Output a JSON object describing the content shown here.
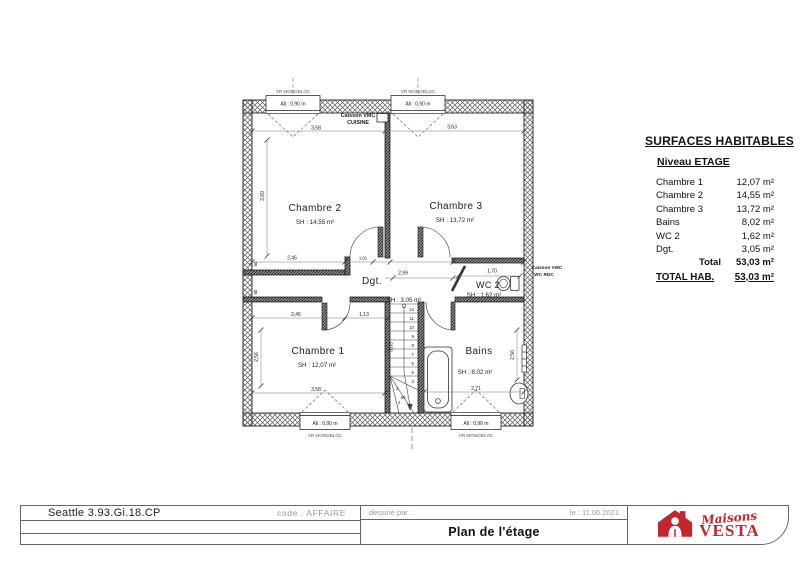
{
  "plan": {
    "rooms": {
      "chambre2": {
        "name": "Chambre 2",
        "area": "SH : 14,55 m²"
      },
      "chambre3": {
        "name": "Chambre 3",
        "area": "SH : 13,72 m²"
      },
      "chambre1": {
        "name": "Chambre 1",
        "area": "SH : 12,07 m²"
      },
      "bains": {
        "name": "Bains",
        "area": "SH : 8,02 m²"
      },
      "wc2": {
        "name": "WC 2",
        "area": "SH : 1,62 m²"
      },
      "dgt": {
        "name": "Dgt.",
        "area": "SH : 3,05 m²"
      }
    },
    "windows": {
      "sill_label": "All : 0,90 m",
      "type_label": "VR MONOBLOC"
    },
    "red_annotations": {
      "vmc_kitchen": {
        "line1": "Caisson VMC",
        "line2": "CUISINE"
      },
      "vmc_wc": {
        "line1": "Caisson VMC",
        "line2": "WC RDC"
      }
    },
    "red_color": "#c1272d",
    "dims": [
      {
        "text": "3,58"
      },
      {
        "text": "3,63"
      },
      {
        "text": "3,60"
      },
      {
        "text": "2,45"
      },
      {
        "text": "73"
      },
      {
        "text": "1,01"
      },
      {
        "text": "2,99"
      },
      {
        "text": "1,70"
      },
      {
        "text": "2,45"
      },
      {
        "text": "1,13"
      },
      {
        "text": "3,03"
      },
      {
        "text": "2,56"
      },
      {
        "text": "2,56"
      },
      {
        "text": "3,58"
      },
      {
        "text": "2,71"
      },
      {
        "text": "85"
      },
      {
        "text": "60"
      },
      {
        "text": "60"
      }
    ],
    "stairs": {
      "numbers": [
        "12",
        "11",
        "10",
        "9",
        "8",
        "7",
        "6",
        "5",
        "4"
      ],
      "winders": [
        "3",
        "2"
      ]
    }
  },
  "surfaces_panel": {
    "title": "SURFACES HABITABLES",
    "level_label": "Niveau ETAGE",
    "rows": [
      {
        "label": "Chambre 1",
        "value": "12,07 m²"
      },
      {
        "label": "Chambre 2",
        "value": "14,55 m²"
      },
      {
        "label": "Chambre 3",
        "value": "13,72 m²"
      },
      {
        "label": "Bains",
        "value": "8,02 m²"
      },
      {
        "label": "WC 2",
        "value": "1,62 m²"
      },
      {
        "label": "Dgt.",
        "value": "3,05 m²"
      }
    ],
    "total_label": "Total",
    "total_value": "53,03 m²",
    "total_hab_label": "TOTAL HAB.",
    "total_hab_value": "53,03 m²"
  },
  "title_block": {
    "reference": "Seattle 3.93.Gi.18.CP",
    "code_label": "code : AFFAIRE",
    "drawn_by_label": "dessiné par :",
    "date_label": "le : 11.06.2021",
    "drawing_title": "Plan de l'étage",
    "logo": {
      "brand_script": "Maisons",
      "brand_name": "VESTA"
    }
  }
}
